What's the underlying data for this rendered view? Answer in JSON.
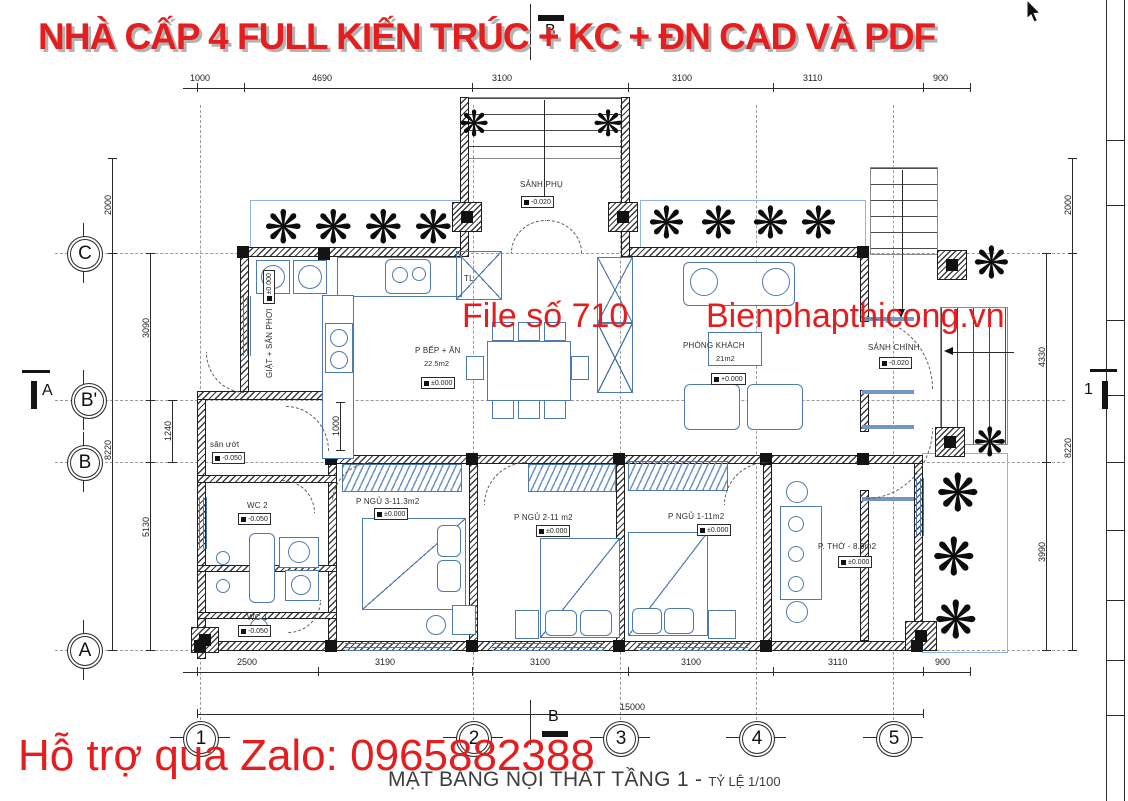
{
  "watermarks": {
    "title": "NHÀ CẤP 4 FULL KIẾN TRÚC + KC + ĐN CAD VÀ PDF",
    "file_number": "File số 710",
    "website": "Bienphapthicong.vn",
    "support": "Hỗ trợ qua Zalo: 0965882388",
    "accent_color": "#e41e1e"
  },
  "caption": {
    "title": "MẶT BẰNG NỘI THẤT TẦNG 1 -",
    "scale": "TỶ LỆ 1/100"
  },
  "grid": {
    "cols": [
      "1",
      "2",
      "3",
      "4",
      "5"
    ],
    "rows": [
      "C",
      "B'",
      "B",
      "A"
    ]
  },
  "sections": {
    "top": "B",
    "bottom": "B",
    "left": "A",
    "right": "1"
  },
  "dims": {
    "top": [
      "1000",
      "4690",
      "3100",
      "3100",
      "3110",
      "900"
    ],
    "bottom": [
      "2500",
      "3190",
      "3100",
      "3100",
      "3110",
      "900"
    ],
    "total": "15000",
    "left_outer": [
      "2000",
      "8220"
    ],
    "left_inner": [
      "3090",
      "1240",
      "5130"
    ],
    "right_inner": [
      "4330",
      "3990"
    ],
    "right_outer": [
      "2000",
      "8220"
    ],
    "kitchen": "1000"
  },
  "rooms": [
    {
      "name": "SẢNH PHỤ",
      "elev": "-0.020"
    },
    {
      "name": "GIẶT + SÂN PHƠI",
      "elev": "±0.000"
    },
    {
      "name": "sân ướt",
      "elev": "-0.050"
    },
    {
      "name": "P BẾP + ĂN",
      "area": "22.5m2",
      "elev": "±0.000"
    },
    {
      "name": "TL"
    },
    {
      "name": "PHÒNG KHÁCH",
      "area": "21m2",
      "elev": "+0.000"
    },
    {
      "name": "SẢNH CHÍNH",
      "elev": "-0.020"
    },
    {
      "name": "WC 2",
      "elev": "-0.050"
    },
    {
      "name": "WC 1",
      "elev": "-0.050"
    },
    {
      "name": "P NGỦ 3-11.3m2",
      "elev": "±0.000"
    },
    {
      "name": "P NGỦ 2-11 m2",
      "elev": "±0.000"
    },
    {
      "name": "P NGỦ 1-11m2",
      "elev": "±0.000"
    },
    {
      "name": "P. THỜ - 8.9m2",
      "elev": "±0.000"
    }
  ],
  "icons": {
    "plant": "❋"
  }
}
